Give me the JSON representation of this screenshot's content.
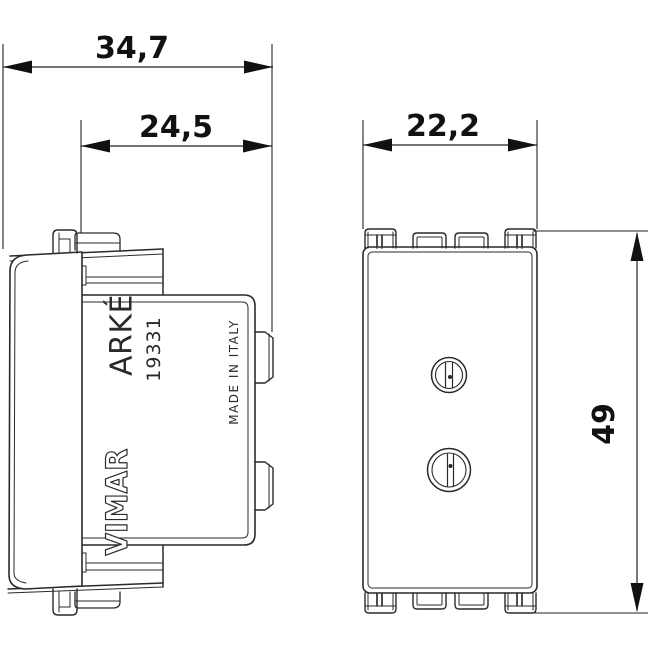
{
  "device": {
    "brand": "VIMAR",
    "series": "ARKÉ",
    "model": "19331",
    "origin": "MADE IN ITALY"
  },
  "dimensions_mm": {
    "overall_depth": "34,7",
    "cage_depth": "24,5",
    "module_width": "22,2",
    "module_height": "49"
  },
  "colors": {
    "background": "#ffffff",
    "line": "#2a2a2a",
    "dimension": "#111111"
  }
}
